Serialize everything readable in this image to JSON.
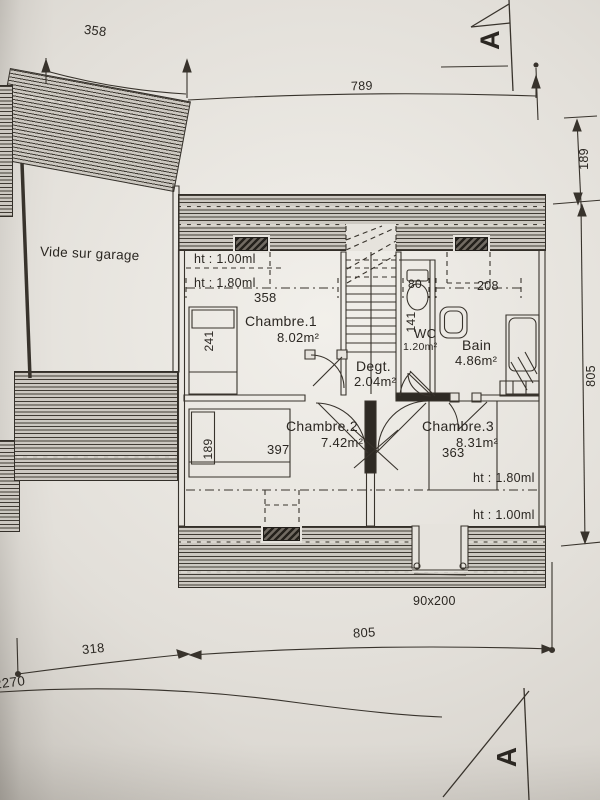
{
  "plan": {
    "garage_label": "Vide sur garage",
    "section_letter": "A",
    "rooms": {
      "chambre1": {
        "name": "Chambre.1",
        "area": "8.02m²"
      },
      "chambre2": {
        "name": "Chambre.2",
        "area": "7.42m²"
      },
      "chambre3": {
        "name": "Chambre.3",
        "area": "8.31m²"
      },
      "bain": {
        "name": "Bain",
        "area": "4.86m²"
      },
      "wc": {
        "name": "WC",
        "area": "1.20m²"
      },
      "degagement": {
        "name": "Degt.",
        "area": "2.04m²"
      }
    },
    "heights": {
      "top_h100": "ht : 1.00ml",
      "top_h180": "ht : 1.80ml",
      "bottom_h180": "ht : 1.80ml",
      "bottom_h100": "ht : 1.00ml"
    },
    "dims": {
      "garage_width": "358",
      "overall_top": "789",
      "right_top": "189",
      "right_side": "805",
      "chambre1_width": "358",
      "chambre1_depth": "241",
      "wc_width": "80",
      "wc_depth": "141",
      "bain_width": "208",
      "chambre2_bed": "189",
      "chambre2_width": "397",
      "chambre3_width": "363",
      "door": "90x200",
      "overall_bottom": "805",
      "bottom_left": "318",
      "left_total": "2270"
    }
  }
}
